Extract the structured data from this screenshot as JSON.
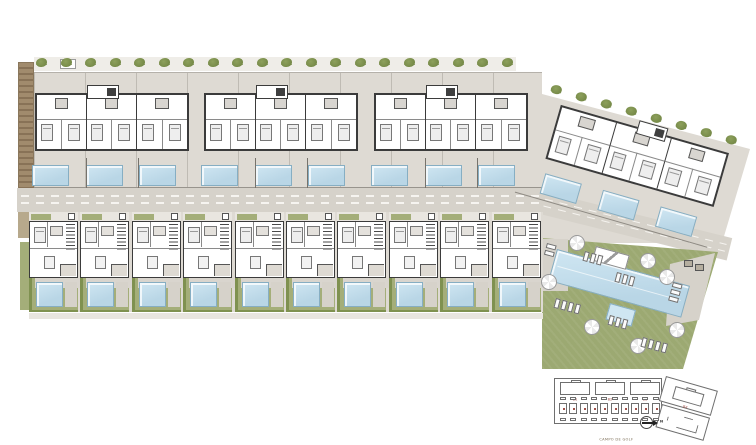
{
  "title": "Residential development site plan",
  "colors": {
    "paving": "#dedad3",
    "paving_dark": "#d6d2ca",
    "wall": "#3b3b3b",
    "room_line": "#8a8a8a",
    "pool_fill": "#b9d6e6",
    "pool_light": "#cfe6f2",
    "pool_edge": "#86aec3",
    "garden": "#a4ae79",
    "lawn": "#9ca972",
    "hedge": "#7f9150",
    "tree": "#6d8140",
    "tree_light": "#8da05c",
    "earth": "#a18b6d",
    "keyplan_line": "#6f6f6f",
    "label_red": "#a0524b",
    "road_dash": "#f6f4f0"
  },
  "site": {
    "apartment_buildings": {
      "count": 3,
      "units_per_building": 3,
      "pools_per_building": 3
    },
    "angled_building": {
      "units": 3,
      "pools": 3,
      "rotation_deg": 16
    },
    "townhouses": {
      "count": 10
    },
    "hedge_trees": {
      "top_row": 20,
      "angled_row": 8
    },
    "communal": {
      "parasols": 7,
      "lounger_groups": 7,
      "pools": [
        "main",
        "spa"
      ]
    }
  },
  "key_plan": {
    "caption": "CAMPO DE GOLF",
    "north_label": "N",
    "building_labels": [
      "B1",
      "B2",
      "B3",
      "B4"
    ],
    "townhouse_count": 10
  }
}
